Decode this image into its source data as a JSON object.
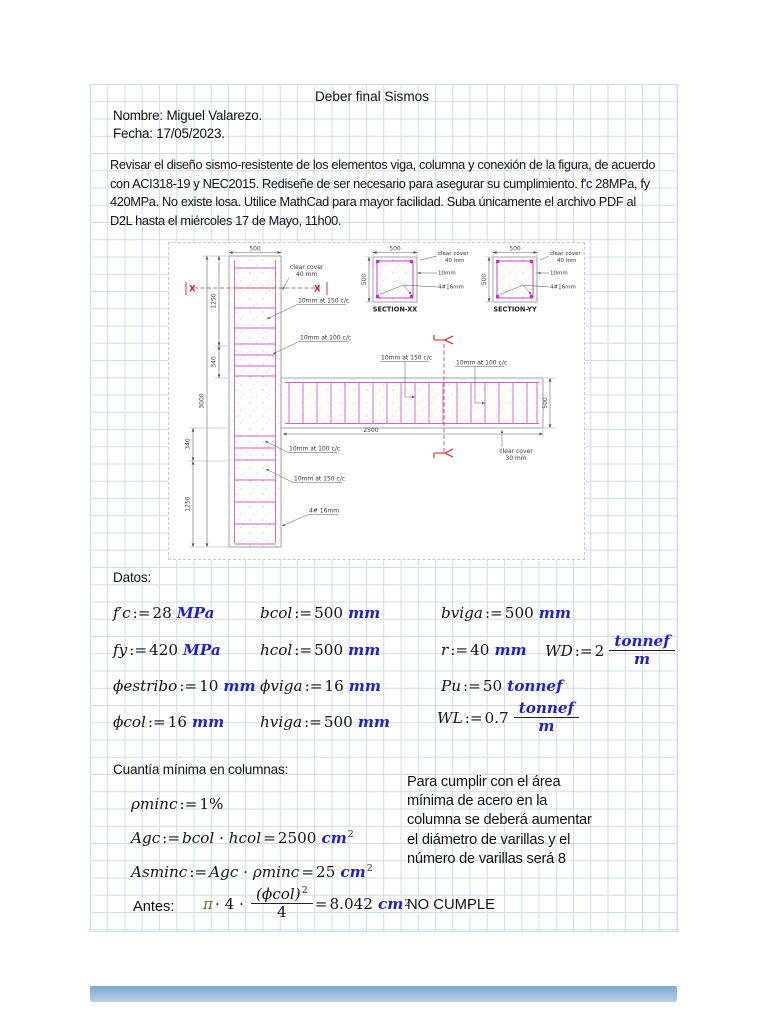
{
  "header": {
    "title": "Deber final Sismos",
    "name_line": "Nombre: Miguel Valarezo.",
    "date_line": "Fecha: 17/05/2023."
  },
  "assignment": {
    "lines": [
      "Revisar el diseño sismo-resistente de los elementos viga, columna y conexión de la figura, de acuerdo",
      "con ACI318-19 y NEC2015. Rediseñe de ser necesario para asegurar su cumplimiento. f'c 28MPa, fy",
      "420MPa. No existe losa. Utilice MathCad para mayor facilidad. Suba únicamente el archivo PDF al",
      "D2L hasta el miércoles 17 de Mayo, 11h00."
    ]
  },
  "figure": {
    "dims": {
      "col_width": "500",
      "upper_height": "1250",
      "upper_zone": "340",
      "total_height": "3000",
      "lower_zone": "340",
      "lower_height": "1250",
      "beam_length": "2500",
      "beam_depth": "500"
    },
    "marks": {
      "x": "X"
    },
    "labels": {
      "cover40_l1": "clear cover",
      "cover40_l2": "40 mm",
      "col_stirrups_150": "10mm at 150 c/c",
      "col_stirrups_100": "10mm at 100 c/c",
      "beam_stirrups_150": "10mm at 150 c/c",
      "beam_stirrups_100": "10mm at 100 c/c",
      "cover30_l1": "clear cover",
      "cover30_l2": "30 mm",
      "lower_stirrups_100": "10mm at 100 c/c",
      "lower_stirrups_150": "10mm at 150 c/c",
      "long_bars": "4# 16mm"
    },
    "section_xx": {
      "dim_w": "500",
      "dim_h": "500",
      "cover_l1": "clear cover",
      "cover_l2": "40 mm",
      "tie": "10mm",
      "bars": "4#16mm",
      "title": "SECTION-XX"
    },
    "section_yy": {
      "dim_w": "500",
      "dim_h": "500",
      "cover_l1": "clear cover",
      "cover_l2": "40 mm",
      "tie": "10mm",
      "bars": "4#16mm",
      "title": "SECTION-YY"
    }
  },
  "datos": {
    "heading": "Datos:",
    "fc": {
      "lhs": "f′c",
      "op": ":=",
      "val": "28",
      "unit": "MPa"
    },
    "bcol": {
      "lhs": "bcol",
      "op": ":=",
      "val": "500",
      "unit": "mm"
    },
    "bviga": {
      "lhs": "bviga",
      "op": ":=",
      "val": "500",
      "unit": "mm"
    },
    "fy": {
      "lhs": "fy",
      "op": ":=",
      "val": "420",
      "unit": "MPa"
    },
    "hcol": {
      "lhs": "hcol",
      "op": ":=",
      "val": "500",
      "unit": "mm"
    },
    "r": {
      "lhs": "r",
      "op": ":=",
      "val": "40",
      "unit": "mm"
    },
    "wd": {
      "lhs": "WD",
      "op": ":=",
      "val": "2",
      "num": "tonnef",
      "den": "m"
    },
    "festribo": {
      "lhs": "ϕestribo",
      "op": ":=",
      "val": "10",
      "unit": "mm"
    },
    "fviga": {
      "lhs": "ϕviga",
      "op": ":=",
      "val": "16",
      "unit": "mm"
    },
    "pu": {
      "lhs": "Pu",
      "op": ":=",
      "val": "50",
      "unit": "tonnef"
    },
    "fcol": {
      "lhs": "ϕcol",
      "op": ":=",
      "val": "16",
      "unit": "mm"
    },
    "hviga": {
      "lhs": "hviga",
      "op": ":=",
      "val": "500",
      "unit": "mm"
    },
    "wl": {
      "lhs": "WL",
      "op": ":=",
      "val": "0.7",
      "num": "tonnef",
      "den": "m"
    }
  },
  "cuantia": {
    "heading": "Cuantía mínima en columnas:",
    "rominc": {
      "lhs": "ρminc",
      "op": ":=",
      "val": "1%"
    },
    "agc": {
      "lhs": "Agc",
      "op": ":=",
      "expr": "bcol · hcol",
      "eq": "=",
      "val": "2500",
      "unit": "cm",
      "sup": "2"
    },
    "asminc": {
      "lhs": "Asminc",
      "op": ":=",
      "expr": "Agc · ρminc",
      "eq": "=",
      "val": "25",
      "unit": "cm",
      "sup": "2"
    },
    "antes_label": "Antes:",
    "antes": {
      "pi": "π",
      "mul": "· 4 ·",
      "num": "(ϕcol)",
      "numsup": "2",
      "den": "4",
      "eq": "=",
      "val": "8.042",
      "unit": "cm",
      "sup": "2"
    },
    "note_lines": [
      "Para cumplir con el área",
      "mínima de acero en la",
      "columna se deberá aumentar",
      "el diámetro de varillas y el",
      "número de varillas será 8"
    ],
    "result": "NO CUMPLE"
  },
  "colors": {
    "unit_blue": "#2121cc",
    "pi_green": "#4a8030",
    "grid_blue": "#ccdcf1",
    "rebar_magenta": "#d05fd0",
    "section_red": "#cc2222"
  }
}
